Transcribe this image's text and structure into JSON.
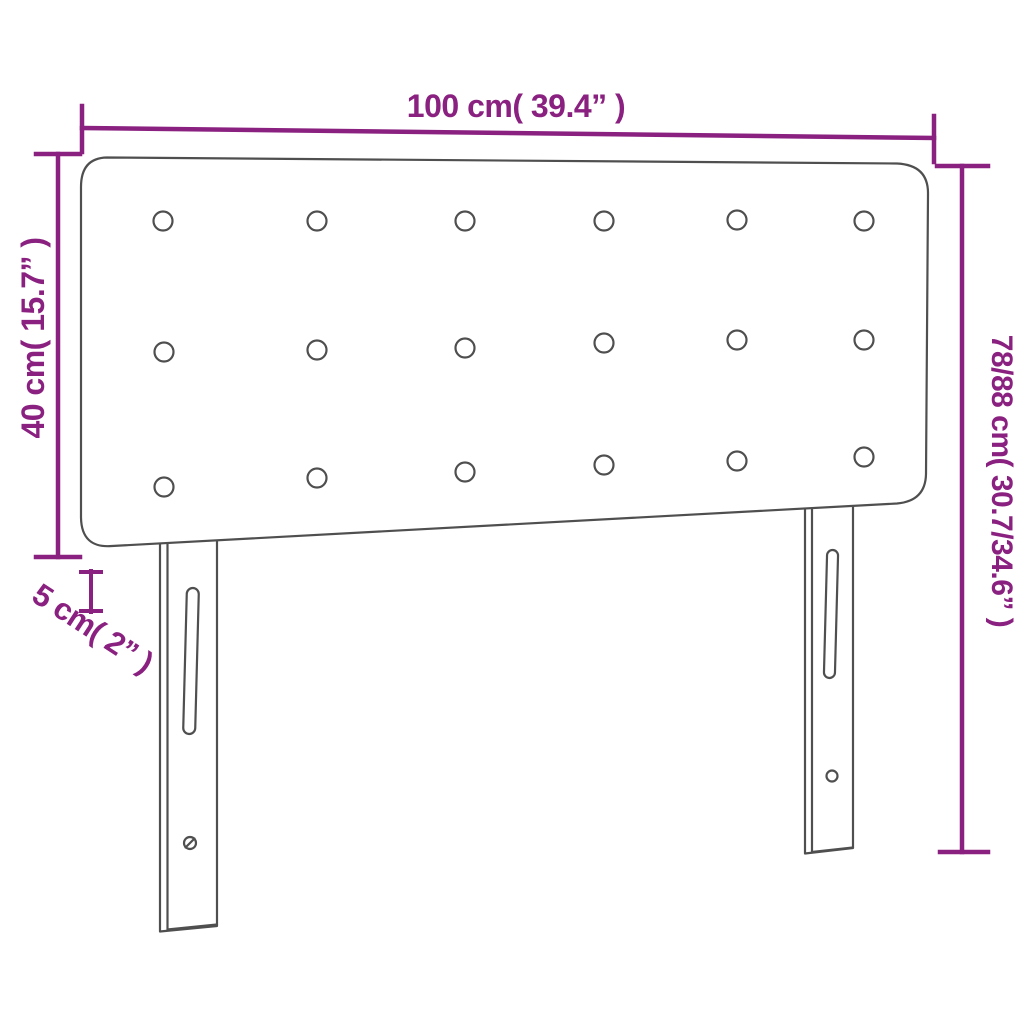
{
  "diagram": {
    "title": "Upholstered headboard dimension diagram",
    "product": "tufted headboard with two mounting legs",
    "labels": {
      "width": "100 cm( 39.4” )",
      "board_height": "40 cm( 15.7” )",
      "total_height": "78/88 cm( 30.7/34.6” )",
      "thickness": "5 cm( 2” )"
    },
    "dimensions": {
      "width_cm": 100,
      "width_in": 39.4,
      "board_height_cm": 40,
      "board_height_in": 15.7,
      "total_height_cm": "78/88",
      "total_height_in": "30.7/34.6",
      "thickness_cm": 5,
      "thickness_in": 2
    },
    "figure": {
      "tufting_button_rows": 3,
      "tufting_button_columns": 6,
      "tufting_buttons_total": 18,
      "legs": 2,
      "leg_features": [
        "vertical adjustment slot",
        "screw hole"
      ]
    },
    "colors": {
      "accent": "#8a2180",
      "outline": "#4f4f4f",
      "background": "#ffffff"
    }
  }
}
